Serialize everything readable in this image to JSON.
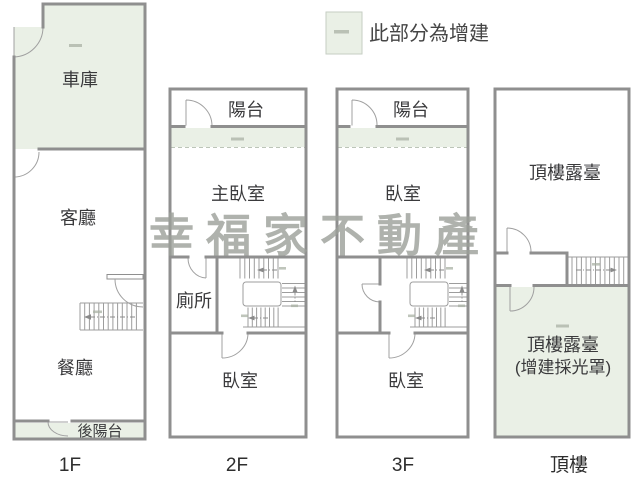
{
  "legend": {
    "label": "此部分為增建"
  },
  "watermark": {
    "text": "幸福家不動產"
  },
  "colors": {
    "addition_fill": "#eaf0e6",
    "wall": "#8f8f8f",
    "label_text": "#3a3a3c",
    "watermark_text": "#9ca099"
  },
  "floors": {
    "f1": {
      "label": "1F",
      "garage": "車庫",
      "living": "客廳",
      "dining": "餐廳",
      "rear_balcony": "後陽台"
    },
    "f2": {
      "label": "2F",
      "balcony": "陽台",
      "master_bedroom": "主臥室",
      "toilet": "廁所",
      "bedroom": "臥室"
    },
    "f3": {
      "label": "3F",
      "balcony": "陽台",
      "bedroom_front": "臥室",
      "bedroom_back": "臥室"
    },
    "roof": {
      "label": "頂樓",
      "terrace": "頂樓露臺",
      "terrace_addition_line1": "頂樓露臺",
      "terrace_addition_line2": "(增建採光罩)"
    }
  }
}
